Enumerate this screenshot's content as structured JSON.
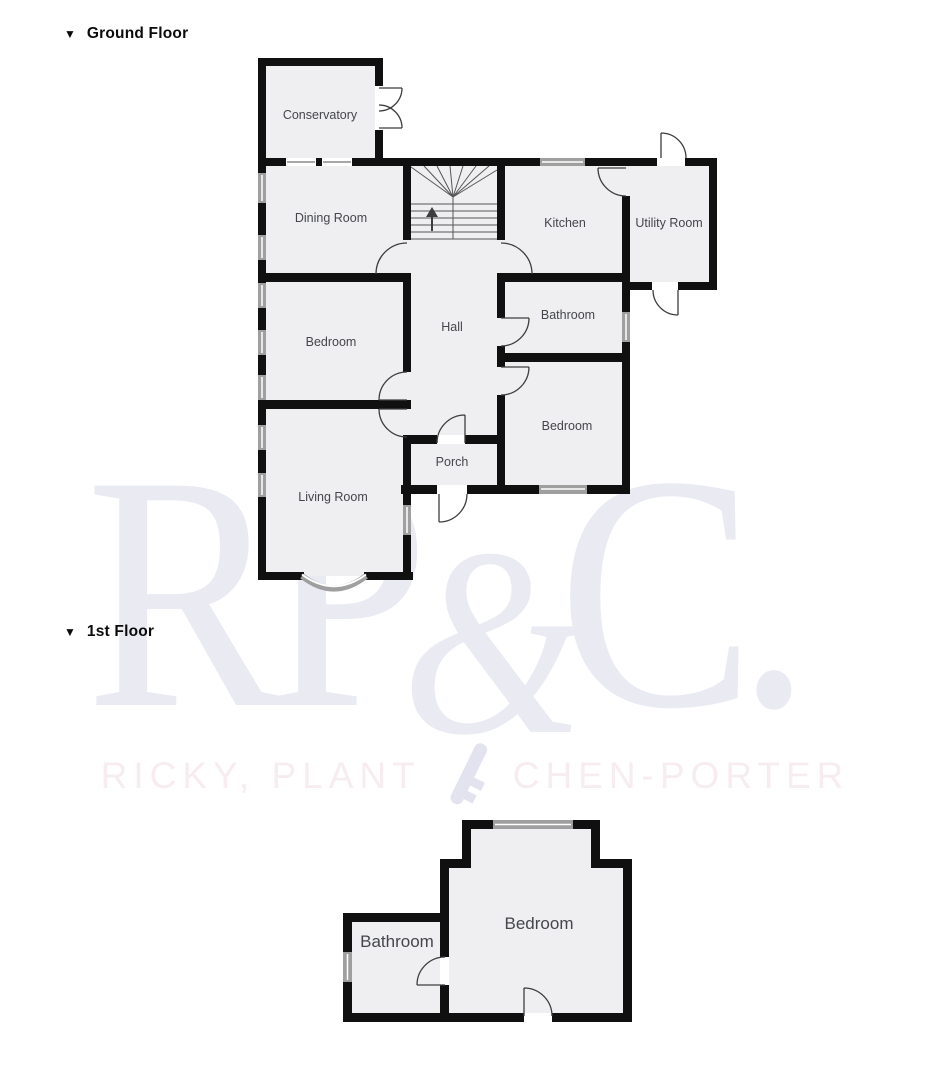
{
  "sections": [
    {
      "title": "Ground Floor"
    },
    {
      "title": "1st Floor"
    }
  ],
  "ground_floor": {
    "rooms": [
      {
        "label": "Conservatory"
      },
      {
        "label": "Dining Room"
      },
      {
        "label": "Kitchen"
      },
      {
        "label": "Utility Room"
      },
      {
        "label": "Hall"
      },
      {
        "label": "Bedroom"
      },
      {
        "label": "Bathroom"
      },
      {
        "label": "Bedroom"
      },
      {
        "label": "Porch"
      },
      {
        "label": "Living Room"
      }
    ]
  },
  "first_floor": {
    "rooms": [
      {
        "label": "Bathroom"
      },
      {
        "label": "Bedroom"
      }
    ]
  },
  "watermark": {
    "monogram_left": "RP",
    "monogram_amp": "&",
    "monogram_right": "C.",
    "tagline_left": "RICKY, PLANT",
    "tagline_right": "CHEN-PORTER",
    "icon": "key-icon"
  },
  "colors": {
    "wall": "#101010",
    "room_fill": "#efeff1",
    "window": "#9f9f9f",
    "door_arc": "#3d3d3d",
    "stairs": "#555555",
    "label_text": "#45464b",
    "monogram": "#e9eaf2",
    "tagline": "#f7edf0",
    "key_icon": "#e2e3ee"
  }
}
